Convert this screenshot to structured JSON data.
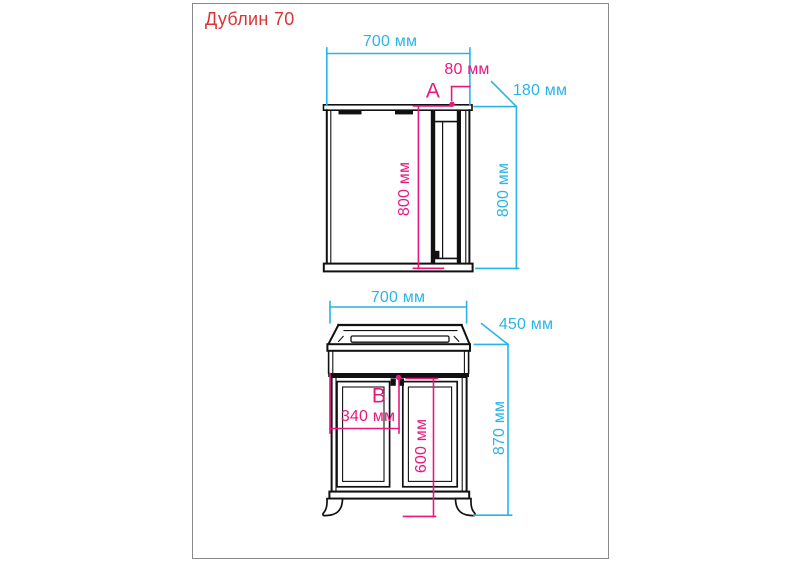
{
  "title": "Дублин 70",
  "colors": {
    "dimension_cyan": "#29b4e8",
    "dimension_pink": "#e7197f",
    "title_red": "#d93535",
    "linework": "#111111"
  },
  "mirror_cabinet": {
    "width": "700 мм",
    "cabinet_section_width": "80 мм",
    "depth": "180 мм",
    "height_inner": "800 мм",
    "height_outer": "800 мм",
    "marker": "A"
  },
  "vanity": {
    "width": "700 мм",
    "depth": "450 мм",
    "handle_offset": "340 мм",
    "body_height": "600 мм",
    "total_height": "870 мм",
    "marker": "B"
  }
}
